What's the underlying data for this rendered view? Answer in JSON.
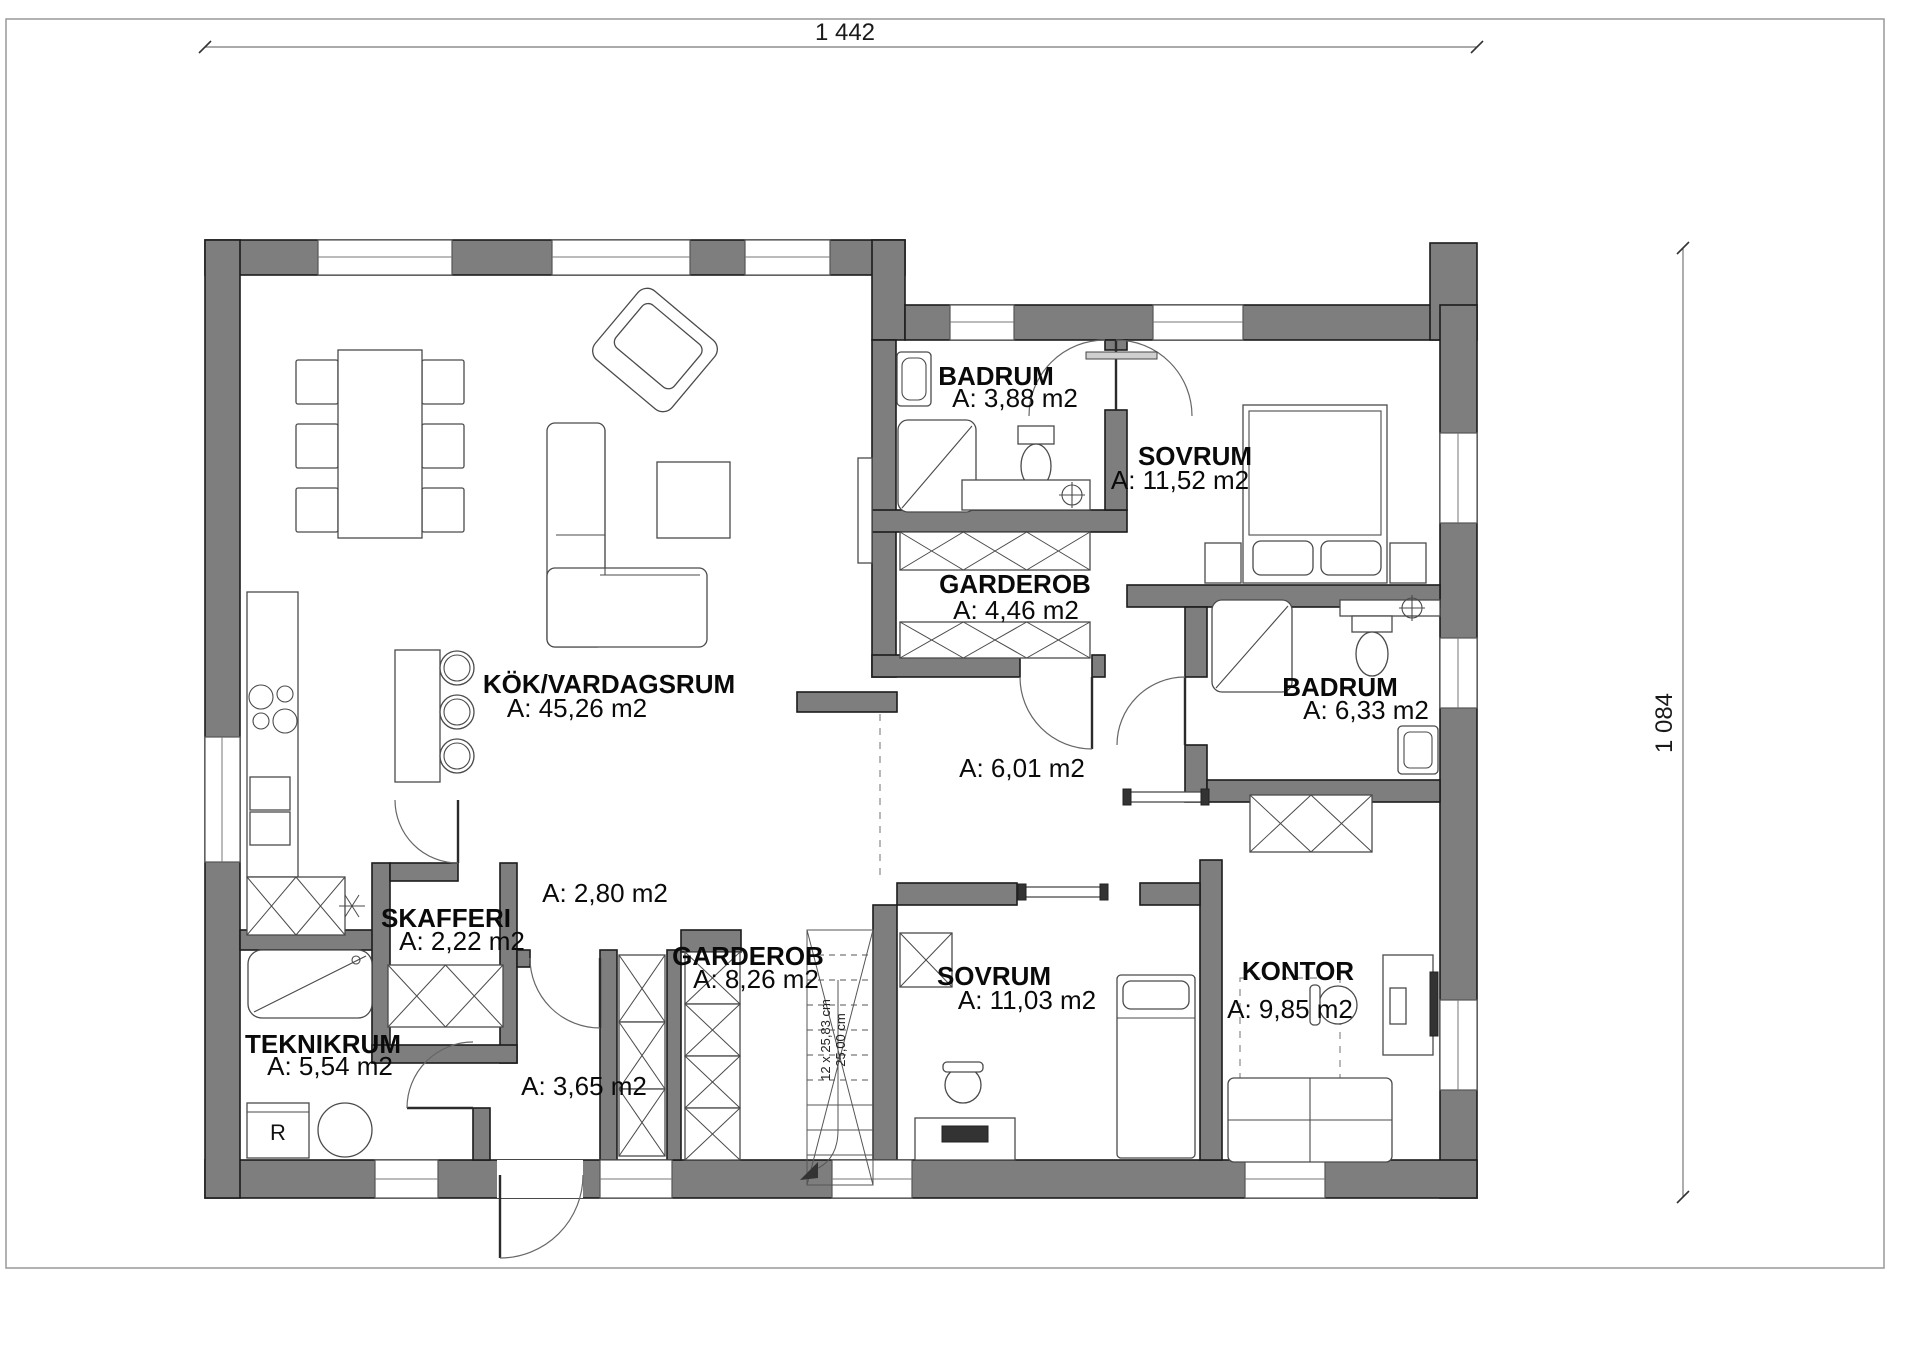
{
  "dimensions": {
    "width_total": "1 442",
    "height_total": "1 084"
  },
  "rooms": {
    "kitchen_living": {
      "name": "KÖK/VARDAGSRUM",
      "area": "A: 45,26 m2"
    },
    "bathroom_top": {
      "name": "BADRUM",
      "area": "A: 3,88 m2"
    },
    "bedroom_top": {
      "name": "SOVRUM",
      "area": "A: 11,52 m2"
    },
    "wardrobe_top": {
      "name": "GARDEROB",
      "area": "A: 4,46 m2"
    },
    "bathroom_right": {
      "name": "BADRUM",
      "area": "A: 6,33 m2"
    },
    "hall_center": {
      "area": "A: 6,01 m2"
    },
    "pantry": {
      "name": "SKAFFERI",
      "area": "A: 2,22 m2"
    },
    "hall_small": {
      "area": "A: 2,80 m2"
    },
    "wardrobe_bottom": {
      "name": "GARDEROB",
      "area": "A: 8,26 m2"
    },
    "tech_room": {
      "name": "TEKNIKRUM",
      "area": "A: 5,54 m2"
    },
    "hall_entry": {
      "area": "A: 3,65 m2"
    },
    "bedroom_bottom": {
      "name": "SOVRUM",
      "area": "A: 11,03 m2"
    },
    "office": {
      "name": "KONTOR",
      "area": "A: 9,85 m2"
    }
  },
  "stairs": {
    "note_line1": "12 x 25,83 cm",
    "note_line2": "25,00 cm"
  },
  "appliances": {
    "tech_room_unit": "R"
  },
  "colors": {
    "wall_fill": "#7e7e7e",
    "outline": "#1c1c1c"
  }
}
